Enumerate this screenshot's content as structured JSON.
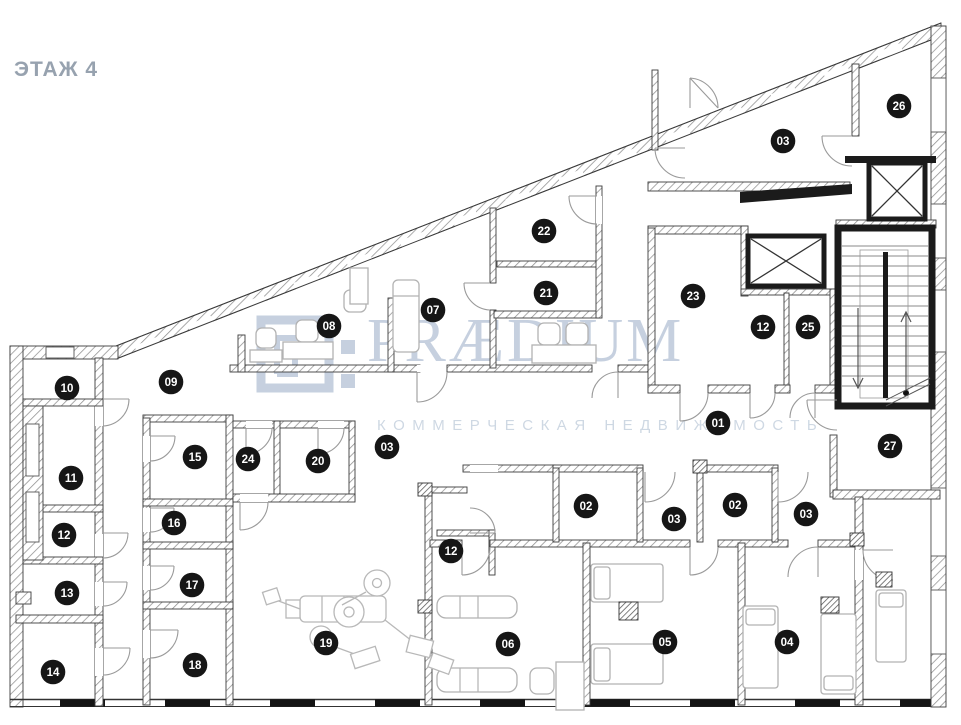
{
  "title": "ЭТАЖ 4",
  "watermark": {
    "brand": "PRÆDIUM",
    "tagline": "КОММЕРЧЕСКАЯ НЕДВИЖИМОСТЬ"
  },
  "colors": {
    "title_text": "#97a2af",
    "watermark_brand": "#c3cede",
    "watermark_tagline": "#ccd6e2",
    "marker_bg": "#161616",
    "marker_text": "#ffffff",
    "wall_dark": "#1b1b1b"
  },
  "marker_radius": 12.3,
  "rooms": [
    {
      "label": "26",
      "x": 899,
      "y": 106
    },
    {
      "label": "03",
      "x": 783,
      "y": 141
    },
    {
      "label": "22",
      "x": 544,
      "y": 231
    },
    {
      "label": "21",
      "x": 546,
      "y": 293
    },
    {
      "label": "23",
      "x": 693,
      "y": 296
    },
    {
      "label": "07",
      "x": 433,
      "y": 310
    },
    {
      "label": "08",
      "x": 329,
      "y": 326
    },
    {
      "label": "12",
      "x": 763,
      "y": 327
    },
    {
      "label": "25",
      "x": 808,
      "y": 327
    },
    {
      "label": "09",
      "x": 171,
      "y": 382
    },
    {
      "label": "10",
      "x": 67,
      "y": 388
    },
    {
      "label": "01",
      "x": 718,
      "y": 423
    },
    {
      "label": "27",
      "x": 890,
      "y": 446
    },
    {
      "label": "03",
      "x": 387,
      "y": 447
    },
    {
      "label": "15",
      "x": 195,
      "y": 457
    },
    {
      "label": "24",
      "x": 248,
      "y": 459
    },
    {
      "label": "20",
      "x": 318,
      "y": 461
    },
    {
      "label": "11",
      "x": 71,
      "y": 478
    },
    {
      "label": "02",
      "x": 586,
      "y": 506
    },
    {
      "label": "02",
      "x": 735,
      "y": 505
    },
    {
      "label": "03",
      "x": 806,
      "y": 514
    },
    {
      "label": "03",
      "x": 674,
      "y": 519
    },
    {
      "label": "16",
      "x": 174,
      "y": 523
    },
    {
      "label": "12",
      "x": 64,
      "y": 535
    },
    {
      "label": "12",
      "x": 451,
      "y": 551
    },
    {
      "label": "13",
      "x": 67,
      "y": 593
    },
    {
      "label": "17",
      "x": 192,
      "y": 585
    },
    {
      "label": "19",
      "x": 326,
      "y": 643
    },
    {
      "label": "06",
      "x": 508,
      "y": 644
    },
    {
      "label": "05",
      "x": 665,
      "y": 642
    },
    {
      "label": "04",
      "x": 787,
      "y": 642
    },
    {
      "label": "14",
      "x": 53,
      "y": 672
    },
    {
      "label": "18",
      "x": 195,
      "y": 665
    }
  ]
}
